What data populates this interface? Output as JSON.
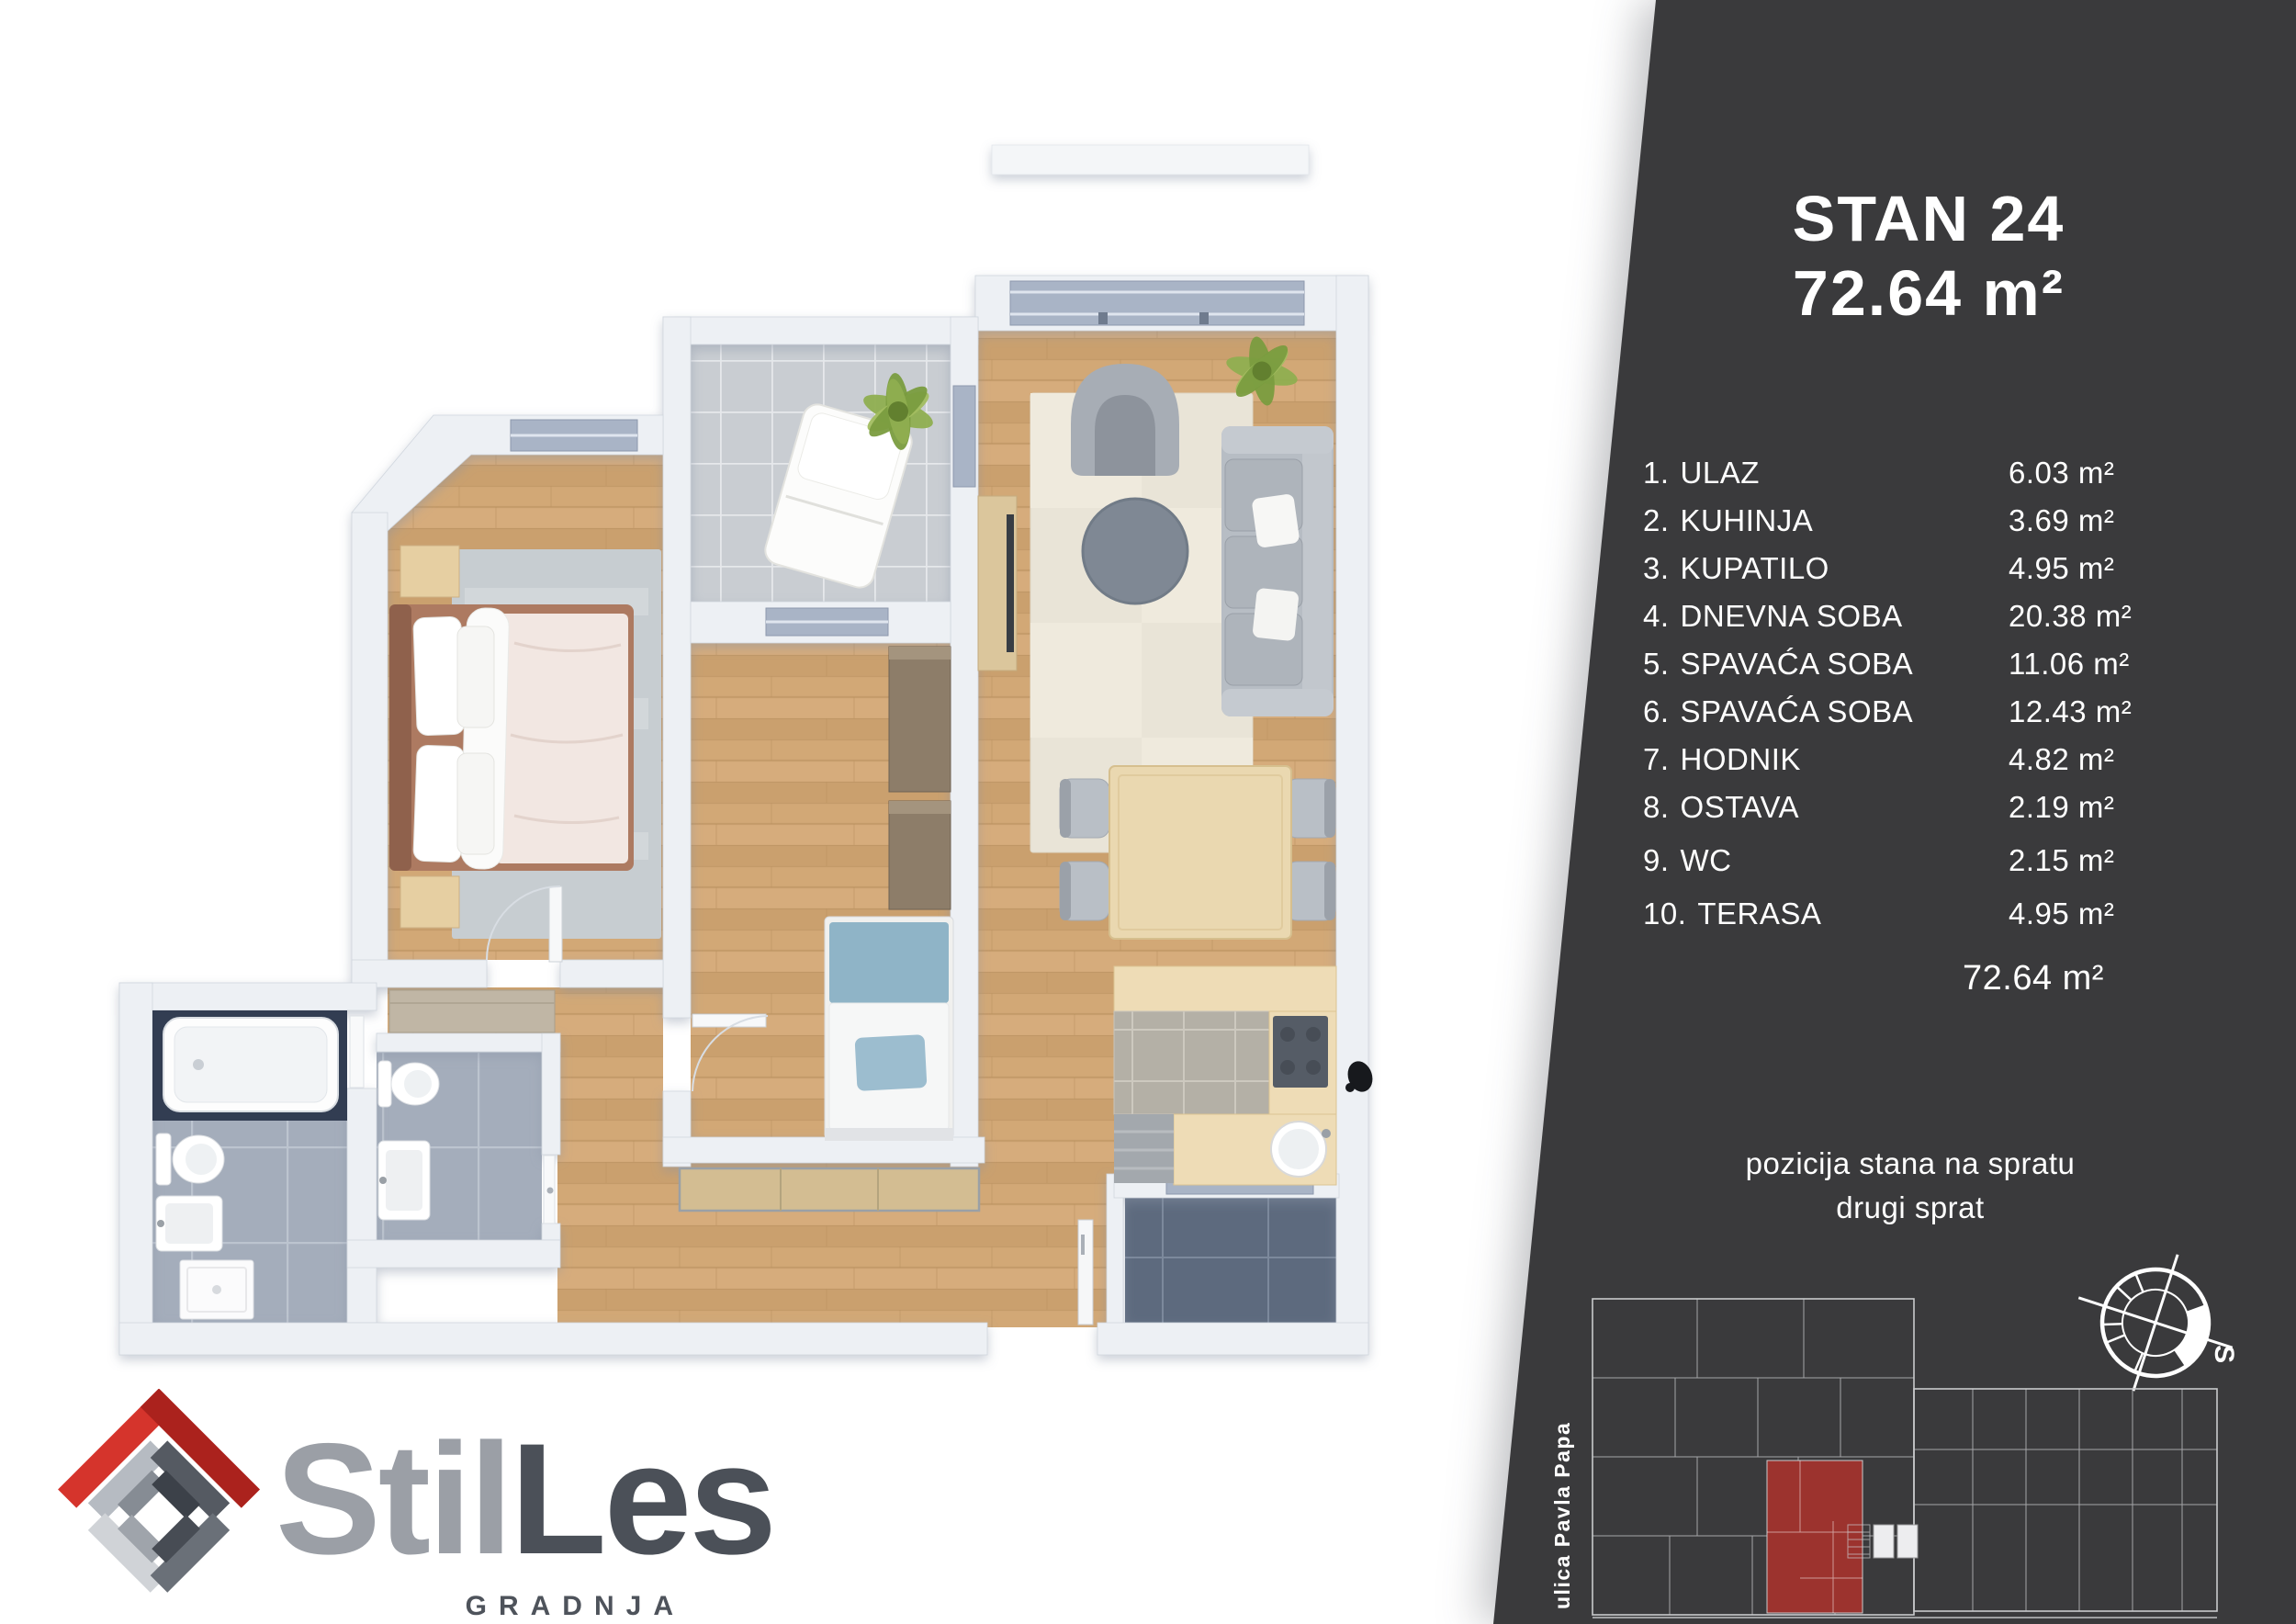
{
  "panel": {
    "title": "STAN 24",
    "area_title": "72.64 m²",
    "rooms": [
      {
        "num": "1.",
        "name": "ULAZ",
        "area": "6.03 m²"
      },
      {
        "num": "2.",
        "name": "KUHINJA",
        "area": "3.69 m²"
      },
      {
        "num": "3.",
        "name": "KUPATILO",
        "area": "4.95 m²"
      },
      {
        "num": "4.",
        "name": "DNEVNA SOBA",
        "area": "20.38 m²"
      },
      {
        "num": "5.",
        "name": "SPAVAĆA SOBA",
        "area": "11.06 m²"
      },
      {
        "num": "6.",
        "name": "SPAVAĆA SOBA",
        "area": "12.43 m²"
      },
      {
        "num": "7.",
        "name": "HODNIK",
        "area": "4.82 m²"
      },
      {
        "num": "8.",
        "name": "OSTAVA",
        "area": "2.19 m²"
      },
      {
        "num": "9.",
        "name": "WC",
        "area": "2.15 m²"
      },
      {
        "num": "10.",
        "name": "TERASA",
        "area": "4.95 m²"
      }
    ],
    "total": "72.64 m²",
    "position_line1": "pozicija stana na spratu",
    "position_line2": "drugi sprat",
    "street_label": "ulica Pavla Papa",
    "compass_label": "S"
  },
  "logo": {
    "name_part1": "Stil",
    "name_part2": "Les",
    "subtitle": "GRADNJA"
  },
  "colors": {
    "panel_bg": "#3a3a3c",
    "unit_highlight_red": "#9c332e",
    "logo_red": "#d5342c",
    "floor_wood": "#cfa474",
    "terrace_dark_tile": "#5d6a7e"
  }
}
